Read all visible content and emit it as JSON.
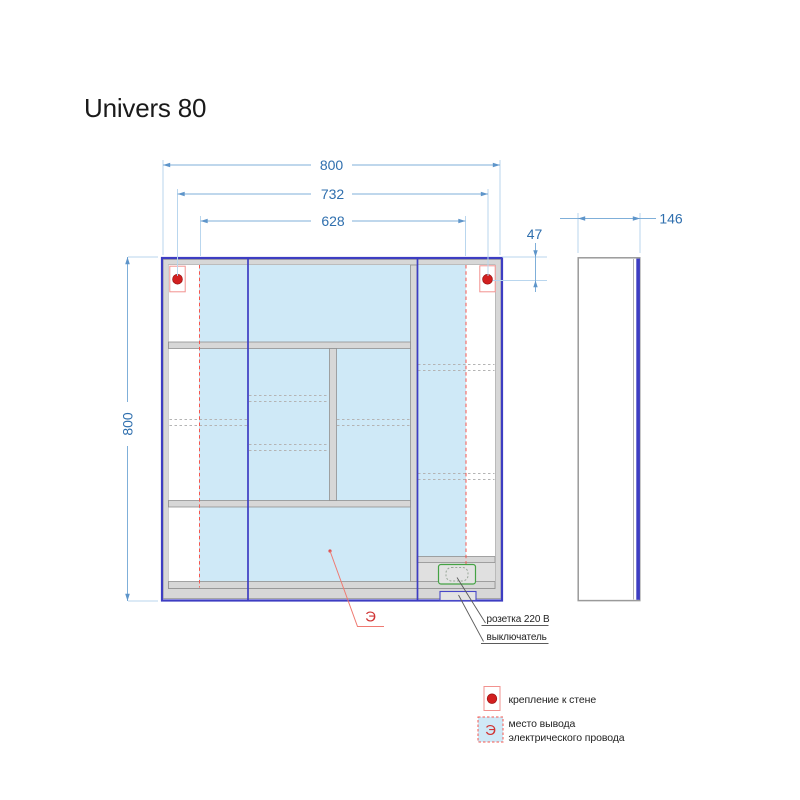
{
  "title": "Univers 80",
  "front_view": {
    "dim_width": "800",
    "dim_mount_spacing": "732",
    "dim_wire_zone_width": "628",
    "dim_mount_offset_top": "47",
    "dim_height": "800"
  },
  "side_view": {
    "dim_depth": "146"
  },
  "callouts": {
    "socket_label": "розетка 220 В",
    "switch_label": "выключатель",
    "wire_zone_symbol": "Э"
  },
  "legend": {
    "wall_mount_label": "крепление к стене",
    "wire_zone_symbol": "Э",
    "wire_zone_label_line1": "место вывода",
    "wire_zone_label_line2": "электрического провода"
  },
  "colors": {
    "door_outline": "#3d3dc2",
    "dimension_text": "#2f6fae",
    "dimension_line": "#7fafd9",
    "extension_line": "#b9d6ee",
    "frame_fill": "#d7d7d7",
    "frame_stroke": "#909090",
    "wire_zone_fill": "#cfe9f7",
    "wire_zone_border": "#f4574f",
    "mount_dot": "#d21f1f",
    "mount_box_stroke": "#f2928f",
    "socket_outline": "#44a244",
    "switch_outline": "#4848c8",
    "zone_symbol_color": "#d03434"
  }
}
